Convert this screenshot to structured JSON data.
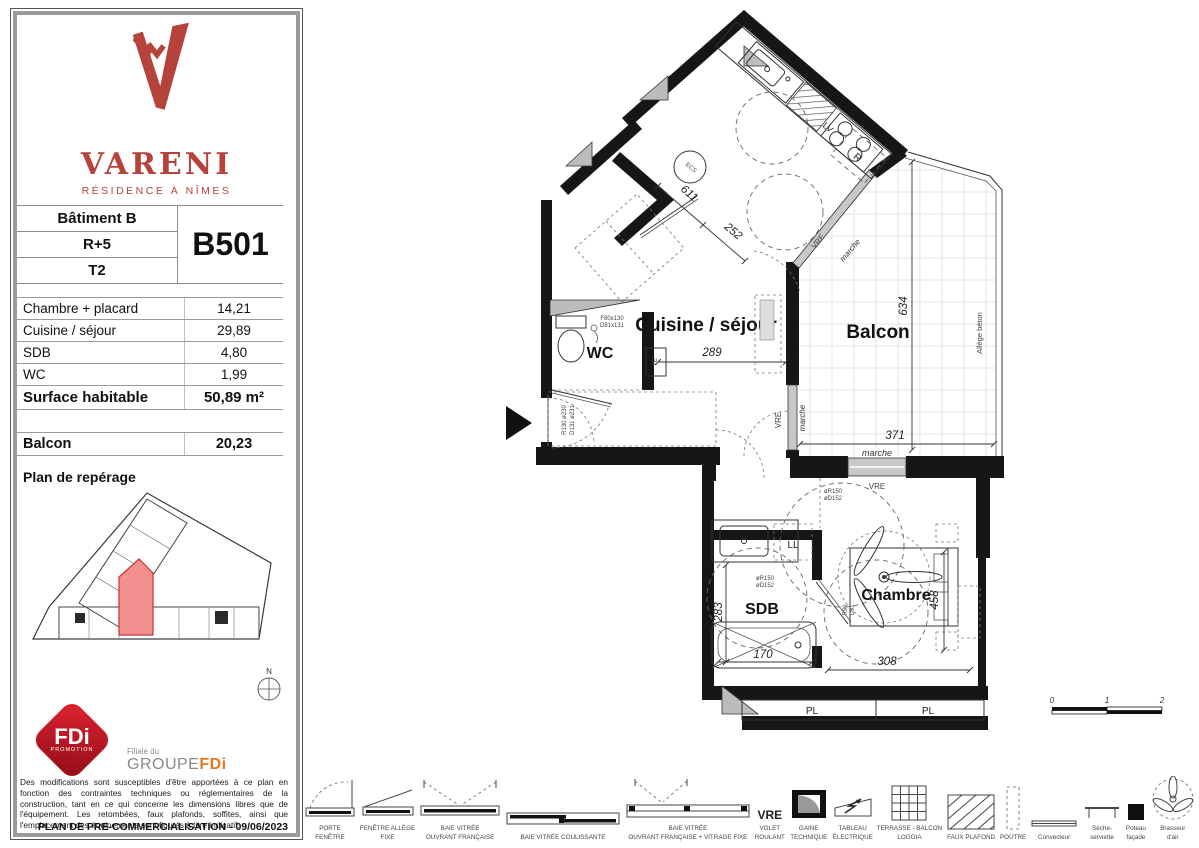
{
  "panel": {
    "brand": {
      "name": "VARENI",
      "subtitle": "RÉSIDENCE À NÎMES"
    },
    "unit": {
      "building": "Bâtiment B",
      "floor": "R+5",
      "type": "T2",
      "code": "B501"
    },
    "areas": {
      "rows": [
        {
          "label": "Chambre  + placard",
          "value": "14,21"
        },
        {
          "label": "Cuisine / séjour",
          "value": "29,89"
        },
        {
          "label": "SDB",
          "value": "4,80"
        },
        {
          "label": "WC",
          "value": "1,99"
        }
      ],
      "total_label": "Surface habitable",
      "total_value": "50,89 m²",
      "balcony_label": "Balcon",
      "balcony_value": "20,23"
    },
    "location_title": "Plan de repérage",
    "north": "N",
    "fdi": {
      "diamond_line1": "FDi",
      "diamond_line2": "PROMOTION",
      "filiale": "Filiale du",
      "group_prefix": "GROUPE",
      "group_suffix": "FDi"
    },
    "disclaimer": "Des modifications sont susceptibles d'être apportées à ce plan en fonction des contraintes techniques ou réglementaires de la construction, tant en ce qui concerne les dimensions libres que de l'équipement. Les retombées, faux plafonds, soffites, ainsi que l'emplacement des équipements sont figurés à titre indicatif.",
    "footer": "PLAN DE PRE-COMMERCIALISATION - 09/06/2023"
  },
  "plan": {
    "rooms": {
      "kitchen_living": "Cuisine / séjour",
      "wc": "WC",
      "balcony": "Balcon",
      "bathroom": "SDB",
      "bedroom": "Chambre"
    },
    "fixtures": {
      "ll": "LL",
      "pl_left": "PL",
      "pl_right": "PL",
      "ecs": "ECS",
      "fridge": "R",
      "lv": "LV",
      "te": "TE"
    },
    "openings": {
      "vre_diag": "VRE",
      "marche_diag": "marche",
      "vre_left": "VRE",
      "marche_left": "marche",
      "vre_bottom": "VRE",
      "marche_bottom": "marche",
      "allege": "Allège béton"
    },
    "dims": {
      "entry_611": "611",
      "entry_252": "252",
      "living_289": "289",
      "balcony_634": "634",
      "balcony_371": "371",
      "bath_283": "283",
      "bath_170": "170",
      "bed_458": "458",
      "bed_308": "308"
    },
    "access": {
      "wc_spec1": "F80x130",
      "wc_spec2": "D81x131",
      "entry_r": "R130 ø230",
      "entry_d": "D131 ø231",
      "bath_r": "øR150",
      "bath_d": "øD152",
      "bed_r": "øR150",
      "bed_d": "øD152",
      "bed_r2": "R90",
      "bed_d2": "D91"
    },
    "scale": {
      "s0": "0",
      "s1": "1",
      "s2": "2"
    }
  },
  "legend": {
    "items": [
      {
        "label": "PORTE\nFENÊTRE"
      },
      {
        "label": "FENÊTRE ALLÈGE\nFIXE"
      },
      {
        "label": "BAIE VITRÉE\nOUVRANT FRANÇAISE"
      },
      {
        "label": "BAIE VITRÉE COULISSANTE"
      },
      {
        "label": "BAIE VITRÉE\nOUVRANT FRANÇAISE + VITRAGE FIXE"
      },
      {
        "label": "VOLET\nROULANT",
        "symbol": "VRE"
      },
      {
        "label": "GAINE\nTECHNIQUE"
      },
      {
        "label": "TABLEAU\nÉLECTRIQUE"
      },
      {
        "label": "TERRASSE - BALCON\nLOGGIA"
      },
      {
        "label": "FAUX PLAFOND"
      },
      {
        "label": "POUTRE"
      },
      {
        "label": "Convecteur"
      },
      {
        "label": "Sèche-\nserviette"
      },
      {
        "label": "Poteau\nfaçade"
      },
      {
        "label": "Brasseur\nd'air"
      }
    ]
  },
  "colors": {
    "brand_red": "#b5433c",
    "fdi_red": "#c41425",
    "fdi_orange": "#e87722",
    "unit_highlight": "#f08a8a"
  }
}
